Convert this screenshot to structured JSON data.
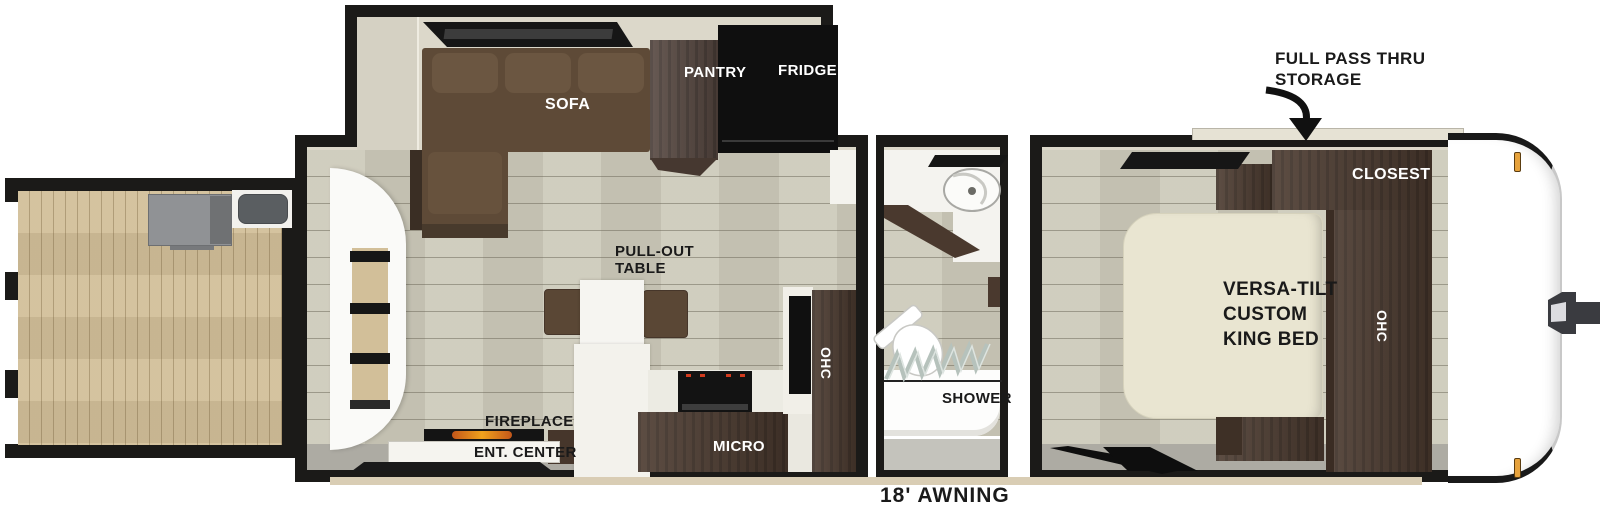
{
  "plan_title": "travel-trailer-floorplan",
  "labels": {
    "sofa": "SOFA",
    "pantry": "PANTRY",
    "fridge": "FRIDGE",
    "pull_out_table_line1": "PULL-OUT",
    "pull_out_table_line2": "TABLE",
    "fireplace": "FIREPLACE",
    "ent_center": "ENT. CENTER",
    "micro": "MICRO",
    "kitchen_ohc": "OHC",
    "shower": "SHOWER",
    "closet": "CLOSEST",
    "bed_line1": "VERSA-TILT",
    "bed_line2": "CUSTOM",
    "bed_line3": "KING BED",
    "bedroom_ohc": "OHC"
  },
  "annotations": {
    "storage_line1": "FULL PASS THRU",
    "storage_line2": "STORAGE",
    "awning": "18' AWNING"
  },
  "fixtures": [
    "rear-deck",
    "deck-railing",
    "outdoor-grill",
    "outdoor-sink",
    "rear-entry-door",
    "slide-out",
    "slide-window",
    "dinette-chairs",
    "stove-cooktop",
    "bath-vanity-sink",
    "toilet",
    "shower-curtain",
    "bedroom-window-top",
    "bedroom-window-bottom",
    "nightstand",
    "bed-bench",
    "pass-thru-hatch",
    "front-cap",
    "hitch-coupler",
    "marker-lights",
    "awning-rail"
  ],
  "colors": {
    "wall": "#1b1a18",
    "interior_wall_face": "#dcd8ca",
    "floor": "#cdcaba",
    "deck_wood": "#d2bf99",
    "cabinet_wood": "#4a392e",
    "sofa_brown": "#5e4a37",
    "bed_cream": "#e9e5d1",
    "flame_orange": "#e8921c",
    "marker_amber": "#e6a23c",
    "gray_band": "#adaba3",
    "awning_tan": "#d9cdb4"
  }
}
